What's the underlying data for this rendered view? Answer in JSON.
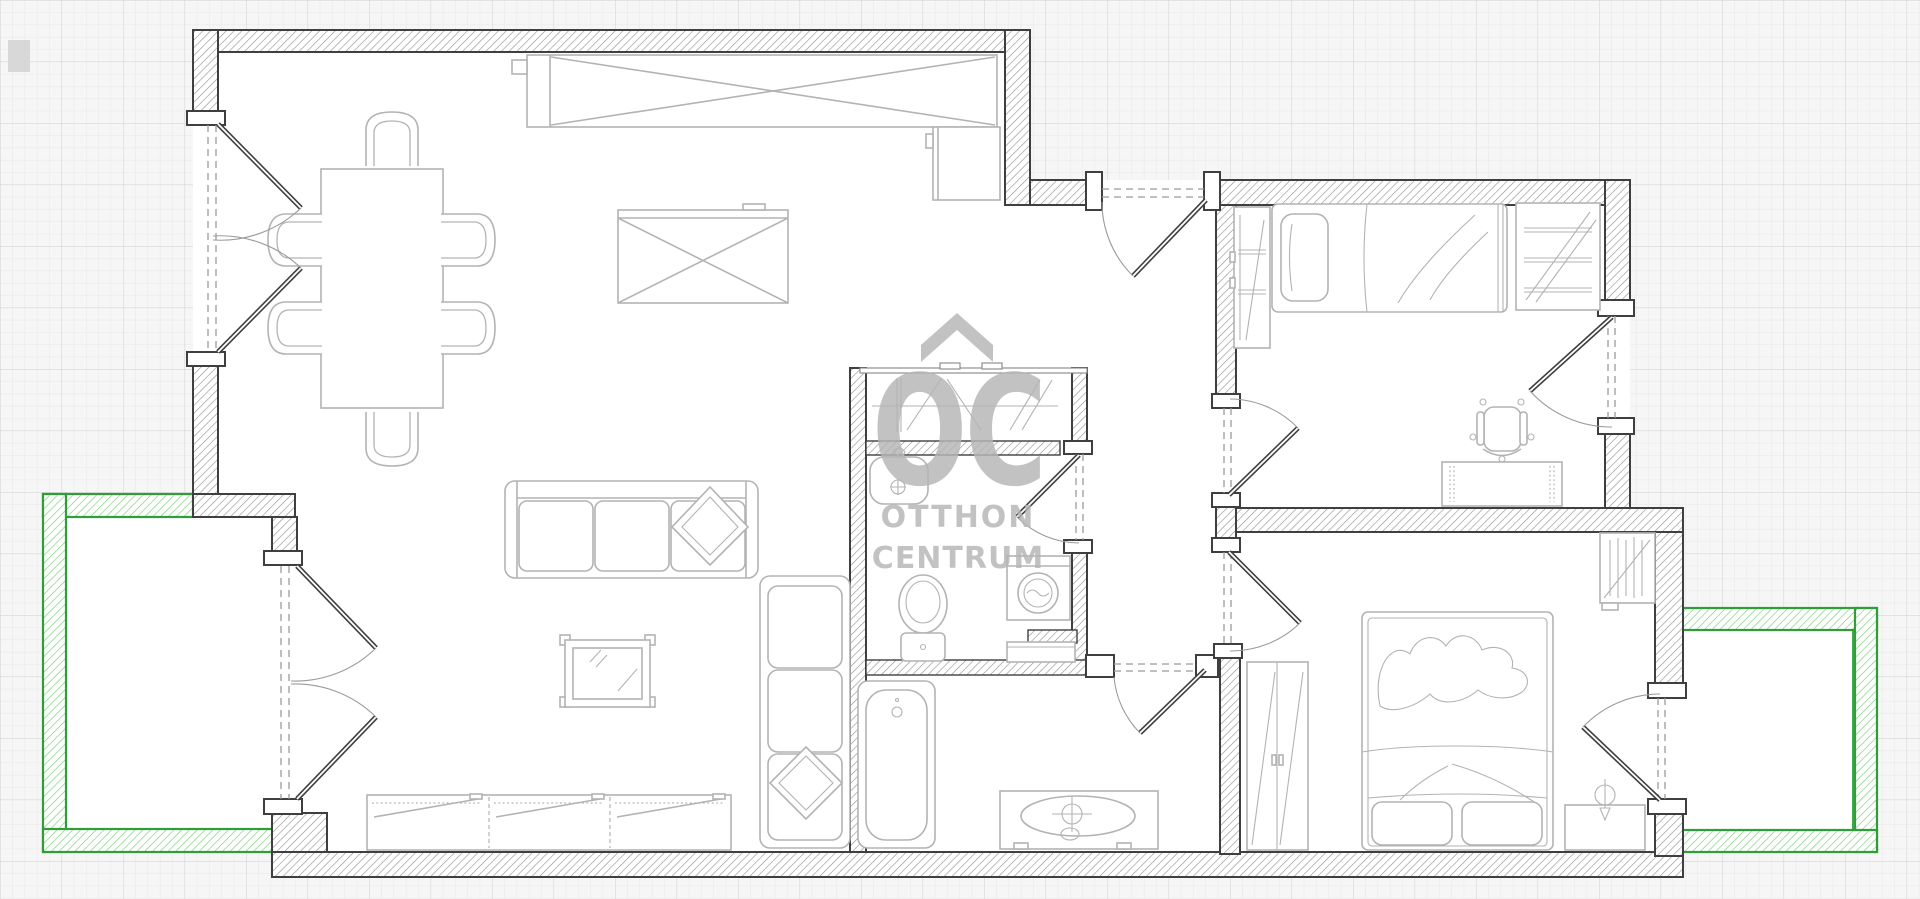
{
  "watermark": {
    "logo": "OC",
    "line1": "OTTHON",
    "line2": "CENTRUM",
    "symbol": "house-roof-chevron",
    "color": "#b5b5b5"
  },
  "palette": {
    "paper": "#f6f6f6",
    "grid_minor": "#e8e8e8",
    "grid_major": "#d6d6d6",
    "floor": "#ffffff",
    "wall_outline": "#3f3f3f",
    "wall_hatch": "#8f8f8f",
    "terrace_outline": "#2f9e38",
    "terrace_hatch": "#7cc47c",
    "furniture_line": "#b3b3b3",
    "door_line": "#3f3f3f",
    "watermark_gray": "#b5b5b5"
  },
  "scene": {
    "type": "apartment-floor-plan",
    "rooms": [
      "living-dining-kitchen",
      "hall",
      "closet",
      "wc-room",
      "bathroom",
      "bedroom-top",
      "bedroom-master",
      "terrace-left",
      "terrace-right"
    ]
  }
}
